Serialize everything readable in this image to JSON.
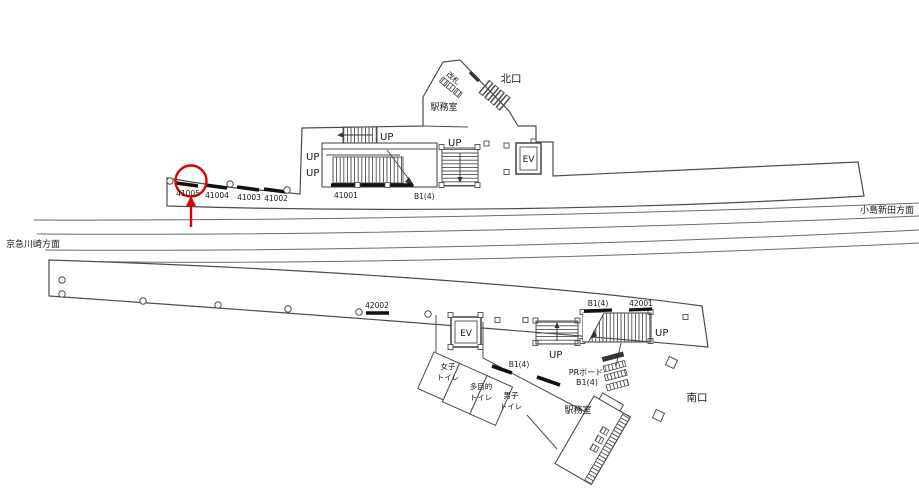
{
  "colors": {
    "background": "#ffffff",
    "outline": "#4d4d4d",
    "track": "#6b6b6b",
    "board": "#111111",
    "highlight_red": "#dd0000",
    "text": "#1a1a1a"
  },
  "station_map": {
    "direction_west": "京急川崎方面",
    "direction_east": "小島新田方面",
    "north_exit": "北口",
    "south_exit": "南口",
    "up": "UP",
    "ev": "EV",
    "gate": "改札",
    "upper": {
      "office": "駅務室",
      "highlighted_board": "41005",
      "boards": [
        {
          "id": "41005"
        },
        {
          "id": "41004"
        },
        {
          "id": "41003"
        },
        {
          "id": "41002"
        },
        {
          "id": "41001"
        }
      ],
      "stair_b1": "B1(4)"
    },
    "lower": {
      "office": "駅務室",
      "board_mid": "42002",
      "stair_b1": "B1(4)",
      "board_right": "42001",
      "b1_small": "B1(4)",
      "pr_line1": "PRボード",
      "pr_line2": "B1(4)",
      "toilet_women_1": "女子",
      "toilet_women_2": "トイレ",
      "toilet_multi_1": "多目的",
      "toilet_multi_2": "トイレ",
      "toilet_men_1": "男子",
      "toilet_men_2": "トイレ"
    }
  }
}
